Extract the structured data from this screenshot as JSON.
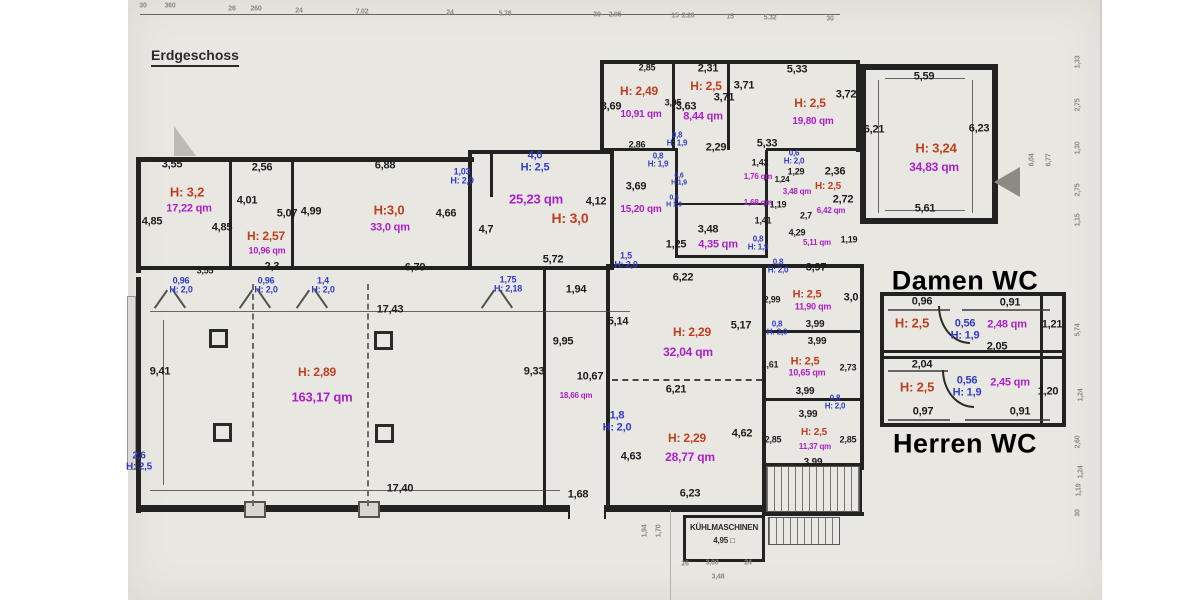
{
  "title": {
    "floor_label": "Erdgeschoss"
  },
  "colors": {
    "height_label": "#c03e1e",
    "area_label": "#ac1fc8",
    "door_label": "#2f3cc9",
    "dimension": "#1c1c1c",
    "paper": "#e9e7e2"
  },
  "headings": {
    "damen_wc": "Damen WC",
    "herren_wc": "Herren WC",
    "kuehlmaschinen": "KÜHLMASCHINEN",
    "kuehl_area": "4,95 □"
  },
  "labels": {
    "dims": [
      {
        "t": "3,55",
        "x": 172,
        "y": 165
      },
      {
        "t": "2,56",
        "x": 262,
        "y": 168
      },
      {
        "t": "6,88",
        "x": 385,
        "y": 166
      },
      {
        "t": "4,01",
        "x": 247,
        "y": 201
      },
      {
        "t": "5,07",
        "x": 287,
        "y": 214
      },
      {
        "t": "4,99",
        "x": 311,
        "y": 212
      },
      {
        "t": "4,85",
        "x": 152,
        "y": 222
      },
      {
        "t": "4,85",
        "x": 222,
        "y": 228
      },
      {
        "t": "4,66",
        "x": 446,
        "y": 214
      },
      {
        "t": "3,55",
        "x": 205,
        "y": 271,
        "s": 9
      },
      {
        "t": "2,3",
        "x": 272,
        "y": 267
      },
      {
        "t": "6,79",
        "x": 415,
        "y": 268
      },
      {
        "t": "4,7",
        "x": 486,
        "y": 230
      },
      {
        "t": "4,12",
        "x": 596,
        "y": 202
      },
      {
        "t": "3,69",
        "x": 636,
        "y": 187
      },
      {
        "t": "5,72",
        "x": 553,
        "y": 260
      },
      {
        "t": "1,94",
        "x": 576,
        "y": 290
      },
      {
        "t": "1,25",
        "x": 676,
        "y": 245
      },
      {
        "t": "2,86",
        "x": 637,
        "y": 145,
        "s": 9
      },
      {
        "t": "2,85",
        "x": 647,
        "y": 68,
        "s": 9
      },
      {
        "t": "3,69",
        "x": 611,
        "y": 107
      },
      {
        "t": "3,95",
        "x": 673,
        "y": 103,
        "s": 9
      },
      {
        "t": "2,31",
        "x": 708,
        "y": 69
      },
      {
        "t": "3,63",
        "x": 686,
        "y": 107
      },
      {
        "t": "3,71",
        "x": 724,
        "y": 98
      },
      {
        "t": "2,29",
        "x": 716,
        "y": 148
      },
      {
        "t": "5,33",
        "x": 797,
        "y": 70
      },
      {
        "t": "3,71",
        "x": 744,
        "y": 86
      },
      {
        "t": "3,72",
        "x": 846,
        "y": 95
      },
      {
        "t": "5,33",
        "x": 767,
        "y": 144
      },
      {
        "t": "1,42",
        "x": 760,
        "y": 163,
        "s": 9
      },
      {
        "t": "1,29",
        "x": 796,
        "y": 172,
        "s": 9
      },
      {
        "t": "1,24",
        "x": 782,
        "y": 180,
        "s": 8
      },
      {
        "t": "1,19",
        "x": 778,
        "y": 205,
        "s": 9
      },
      {
        "t": "1,41",
        "x": 763,
        "y": 221,
        "s": 9
      },
      {
        "t": "2,7",
        "x": 806,
        "y": 216,
        "s": 9
      },
      {
        "t": "2,36",
        "x": 835,
        "y": 172
      },
      {
        "t": "2,72",
        "x": 843,
        "y": 200
      },
      {
        "t": "3,48",
        "x": 708,
        "y": 230
      },
      {
        "t": "4,29",
        "x": 797,
        "y": 233,
        "s": 9
      },
      {
        "t": "1,19",
        "x": 849,
        "y": 240,
        "s": 9
      },
      {
        "t": "5,59",
        "x": 924,
        "y": 77
      },
      {
        "t": "6,21",
        "x": 874,
        "y": 130
      },
      {
        "t": "6,23",
        "x": 979,
        "y": 129
      },
      {
        "t": "5,61",
        "x": 925,
        "y": 209
      },
      {
        "t": "17,43",
        "x": 390,
        "y": 310
      },
      {
        "t": "9,41",
        "x": 160,
        "y": 372
      },
      {
        "t": "17,40",
        "x": 400,
        "y": 489
      },
      {
        "t": "9,95",
        "x": 563,
        "y": 342
      },
      {
        "t": "9,33",
        "x": 534,
        "y": 372
      },
      {
        "t": "10,67",
        "x": 590,
        "y": 377
      },
      {
        "t": "1,68",
        "x": 578,
        "y": 495
      },
      {
        "t": "4,63",
        "x": 631,
        "y": 457
      },
      {
        "t": "6,22",
        "x": 683,
        "y": 278
      },
      {
        "t": "5,14",
        "x": 618,
        "y": 322
      },
      {
        "t": "5,17",
        "x": 741,
        "y": 326
      },
      {
        "t": "6,21",
        "x": 676,
        "y": 390
      },
      {
        "t": "6,23",
        "x": 690,
        "y": 494
      },
      {
        "t": "4,62",
        "x": 742,
        "y": 434
      },
      {
        "t": "3,97",
        "x": 816,
        "y": 268
      },
      {
        "t": "2,99",
        "x": 772,
        "y": 300,
        "s": 9
      },
      {
        "t": "3,0",
        "x": 851,
        "y": 298
      },
      {
        "t": "3,99",
        "x": 815,
        "y": 325,
        "s": 10
      },
      {
        "t": "3,99",
        "x": 817,
        "y": 342,
        "s": 10
      },
      {
        "t": "2,61",
        "x": 770,
        "y": 365,
        "s": 9
      },
      {
        "t": "2,73",
        "x": 848,
        "y": 368,
        "s": 9
      },
      {
        "t": "3,99",
        "x": 805,
        "y": 392,
        "s": 10
      },
      {
        "t": "3,99",
        "x": 808,
        "y": 415,
        "s": 10
      },
      {
        "t": "2,85",
        "x": 773,
        "y": 440,
        "s": 9
      },
      {
        "t": "2,85",
        "x": 848,
        "y": 440,
        "s": 9
      },
      {
        "t": "3,99",
        "x": 813,
        "y": 463,
        "s": 10
      },
      {
        "t": "0,96",
        "x": 922,
        "y": 302
      },
      {
        "t": "0,91",
        "x": 1010,
        "y": 303
      },
      {
        "t": "1,21",
        "x": 1052,
        "y": 325
      },
      {
        "t": "2,05",
        "x": 997,
        "y": 347
      },
      {
        "t": "2,04",
        "x": 922,
        "y": 365
      },
      {
        "t": "1,20",
        "x": 1048,
        "y": 392
      },
      {
        "t": "0,97",
        "x": 923,
        "y": 412
      },
      {
        "t": "0,91",
        "x": 1020,
        "y": 412
      }
    ],
    "heights": [
      {
        "t": "H: 3,2",
        "x": 187,
        "y": 192,
        "s": 13
      },
      {
        "t": "H: 2,57",
        "x": 266,
        "y": 236
      },
      {
        "t": "H:3,0",
        "x": 389,
        "y": 210,
        "s": 13
      },
      {
        "t": "H: 3,0",
        "x": 570,
        "y": 218,
        "s": 14
      },
      {
        "t": "H: 2,49",
        "x": 639,
        "y": 91
      },
      {
        "t": "H: 2,5",
        "x": 706,
        "y": 86
      },
      {
        "t": "H: 2,5",
        "x": 810,
        "y": 103
      },
      {
        "t": "H: 2,5",
        "x": 828,
        "y": 187,
        "s": 10
      },
      {
        "t": "H: 3,24",
        "x": 936,
        "y": 148,
        "s": 13
      },
      {
        "t": "H: 2,89",
        "x": 317,
        "y": 372
      },
      {
        "t": "H: 2,29",
        "x": 692,
        "y": 332
      },
      {
        "t": "H: 2,5",
        "x": 807,
        "y": 295,
        "s": 11
      },
      {
        "t": "H: 2,5",
        "x": 805,
        "y": 362,
        "s": 11
      },
      {
        "t": "H: 2,29",
        "x": 687,
        "y": 438
      },
      {
        "t": "H: 2,5",
        "x": 814,
        "y": 433,
        "s": 10
      },
      {
        "t": "H: 2,5",
        "x": 912,
        "y": 323,
        "s": 13
      },
      {
        "t": "H: 2,5",
        "x": 917,
        "y": 387,
        "s": 13
      }
    ],
    "areas": [
      {
        "t": "17,22 qm",
        "x": 189,
        "y": 209
      },
      {
        "t": "10,96 qm",
        "x": 267,
        "y": 251,
        "s": 9
      },
      {
        "t": "33,0 qm",
        "x": 390,
        "y": 228
      },
      {
        "t": "25,23 qm",
        "x": 536,
        "y": 199,
        "s": 13
      },
      {
        "t": "15,20 qm",
        "x": 641,
        "y": 210,
        "s": 10
      },
      {
        "t": "10,91 qm",
        "x": 641,
        "y": 115,
        "s": 10
      },
      {
        "t": "8,44 qm",
        "x": 703,
        "y": 117
      },
      {
        "t": "19,80 qm",
        "x": 813,
        "y": 122,
        "s": 10
      },
      {
        "t": "1,76 qm",
        "x": 758,
        "y": 177,
        "s": 8
      },
      {
        "t": "3,48 qm",
        "x": 797,
        "y": 192,
        "s": 8
      },
      {
        "t": "1,68 qm",
        "x": 758,
        "y": 203,
        "s": 8
      },
      {
        "t": "6,42 qm",
        "x": 831,
        "y": 211,
        "s": 8
      },
      {
        "t": "4,35 qm",
        "x": 718,
        "y": 245
      },
      {
        "t": "5,11 qm",
        "x": 817,
        "y": 243,
        "s": 8
      },
      {
        "t": "34,83 qm",
        "x": 934,
        "y": 167,
        "s": 12
      },
      {
        "t": "163,17 qm",
        "x": 322,
        "y": 397,
        "s": 13
      },
      {
        "t": "32,04 qm",
        "x": 688,
        "y": 352,
        "s": 12
      },
      {
        "t": "11,90 qm",
        "x": 813,
        "y": 307,
        "s": 9
      },
      {
        "t": "10,65 qm",
        "x": 807,
        "y": 373,
        "s": 9
      },
      {
        "t": "18,66 qm",
        "x": 576,
        "y": 396,
        "s": 8
      },
      {
        "t": "28,77 qm",
        "x": 690,
        "y": 457,
        "s": 12
      },
      {
        "t": "11,37 qm",
        "x": 815,
        "y": 447,
        "s": 8
      },
      {
        "t": "2,48 qm",
        "x": 1007,
        "y": 325,
        "s": 11
      },
      {
        "t": "2,45 qm",
        "x": 1010,
        "y": 383,
        "s": 11
      }
    ],
    "doors": [
      {
        "w": "1,03",
        "h": "H: 2,0",
        "x": 462,
        "y": 177,
        "s": 9
      },
      {
        "w": "4,0",
        "h": "H: 2,5",
        "x": 535,
        "y": 162,
        "s": 11
      },
      {
        "w": "0,96",
        "h": "H: 2,0",
        "x": 181,
        "y": 286,
        "s": 9
      },
      {
        "w": "0,96",
        "h": "H: 2,0",
        "x": 266,
        "y": 286,
        "s": 9
      },
      {
        "w": "1,4",
        "h": "H: 2,0",
        "x": 323,
        "y": 286,
        "s": 9
      },
      {
        "w": "1,75",
        "h": "H: 2,18",
        "x": 508,
        "y": 285,
        "s": 9
      },
      {
        "w": "1,5",
        "h": "H: 2,0",
        "x": 626,
        "y": 261,
        "s": 9
      },
      {
        "w": "0,8",
        "h": "H: 1,9",
        "x": 677,
        "y": 140,
        "s": 8
      },
      {
        "w": "0,8",
        "h": "H: 1,9",
        "x": 658,
        "y": 161,
        "s": 8
      },
      {
        "w": "0,6",
        "h": "H 1,9",
        "x": 679,
        "y": 180,
        "s": 7
      },
      {
        "w": "0,6",
        "h": "H 1,9",
        "x": 674,
        "y": 202,
        "s": 7
      },
      {
        "w": "0,6",
        "h": "H: 2,0",
        "x": 794,
        "y": 158,
        "s": 8
      },
      {
        "w": "0,8",
        "h": "H: 1,9",
        "x": 758,
        "y": 244,
        "s": 8
      },
      {
        "w": "0,8",
        "h": "H: 2,0",
        "x": 778,
        "y": 267,
        "s": 8
      },
      {
        "w": "0,8",
        "h": "H: 2,0",
        "x": 777,
        "y": 329,
        "s": 8
      },
      {
        "w": "0,8",
        "h": "H: 2,0",
        "x": 835,
        "y": 403,
        "s": 8
      },
      {
        "w": "0,56",
        "h": "H: 1,9",
        "x": 965,
        "y": 330,
        "s": 11
      },
      {
        "w": "0,56",
        "h": "H: 1,9",
        "x": 967,
        "y": 387,
        "s": 11
      },
      {
        "w": "2,6",
        "h": "H: 2,5",
        "x": 139,
        "y": 462,
        "s": 10
      },
      {
        "w": "1,8",
        "h": "H: 2,0",
        "x": 617,
        "y": 422,
        "s": 11
      }
    ],
    "top_chain": [
      {
        "t": "30",
        "x": 143,
        "y": 6
      },
      {
        "t": "360",
        "x": 170,
        "y": 6
      },
      {
        "t": "26",
        "x": 232,
        "y": 9
      },
      {
        "t": "260",
        "x": 256,
        "y": 9
      },
      {
        "t": "24",
        "x": 299,
        "y": 11
      },
      {
        "t": "7.02",
        "x": 362,
        "y": 12
      },
      {
        "t": "24",
        "x": 450,
        "y": 13
      },
      {
        "t": "5.76",
        "x": 505,
        "y": 14
      },
      {
        "t": "30",
        "x": 597,
        "y": 15
      },
      {
        "t": "2.95",
        "x": 615,
        "y": 15
      },
      {
        "t": "15",
        "x": 675,
        "y": 16
      },
      {
        "t": "2.26",
        "x": 688,
        "y": 16
      },
      {
        "t": "15",
        "x": 730,
        "y": 17
      },
      {
        "t": "5.32",
        "x": 770,
        "y": 18
      },
      {
        "t": "30",
        "x": 830,
        "y": 19
      }
    ],
    "side_dims": [
      {
        "t": "6,04",
        "x": 1032,
        "y": 160,
        "r": -90
      },
      {
        "t": "6,77",
        "x": 1049,
        "y": 160,
        "r": -90
      },
      {
        "t": "1,33",
        "x": 1078,
        "y": 62,
        "r": -90
      },
      {
        "t": "2,75",
        "x": 1078,
        "y": 105,
        "r": -90
      },
      {
        "t": "1,30",
        "x": 1078,
        "y": 148,
        "r": -90
      },
      {
        "t": "2,75",
        "x": 1078,
        "y": 190,
        "r": -90
      },
      {
        "t": "1,15",
        "x": 1078,
        "y": 220,
        "r": -90
      },
      {
        "t": "5,74",
        "x": 1078,
        "y": 330,
        "r": -90
      },
      {
        "t": "1,24",
        "x": 1081,
        "y": 395,
        "r": -90
      },
      {
        "t": "2,60",
        "x": 1078,
        "y": 442,
        "r": -90
      },
      {
        "t": "1,24",
        "x": 1081,
        "y": 472,
        "r": -90
      },
      {
        "t": "1,19",
        "x": 1079,
        "y": 490,
        "r": -90
      },
      {
        "t": "30",
        "x": 1078,
        "y": 513,
        "r": -90
      },
      {
        "t": "1,94",
        "x": 645,
        "y": 531,
        "r": -90
      },
      {
        "t": "1,70",
        "x": 659,
        "y": 531,
        "r": -90
      },
      {
        "t": "26",
        "x": 685,
        "y": 564,
        "r": 0
      },
      {
        "t": "3,00",
        "x": 712,
        "y": 563,
        "r": 0
      },
      {
        "t": "24",
        "x": 748,
        "y": 563,
        "r": 0
      },
      {
        "t": "3,48",
        "x": 718,
        "y": 577,
        "r": 0
      }
    ]
  }
}
